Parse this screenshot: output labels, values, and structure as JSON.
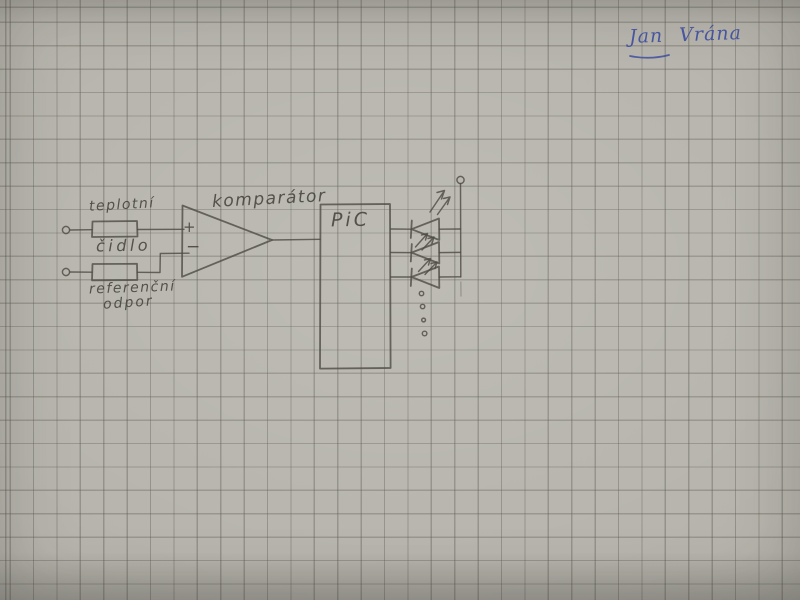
{
  "photo": {
    "type": "hand-drawn circuit sketch on squared graph paper",
    "colors": {
      "paper": "#b6b4ac",
      "grid_line": "#94928a",
      "pencil": "#4e4c45",
      "ink_blue": "#3d4d9f"
    },
    "signature": "Jan Vrána"
  },
  "diagram": {
    "labels": {
      "sensor_line1": "teplotní",
      "sensor_line2": "čidlo",
      "reference_line1": "referenční",
      "reference_line2": "odpor",
      "comparator": "komparátor",
      "plus": "+",
      "minus": "−",
      "mcu": "PiC"
    },
    "symbols": {
      "input-terminal-icon": "small open circle",
      "resistor-icon": "rectangle box",
      "comparator-icon": "triangle pointing right with + and − inputs",
      "led-icon": "left-pointing triangle with cathode bar and two emission arrows",
      "supply-terminal-icon": "small open circle on vertical bus",
      "more-outputs-icon": "vertical column of four small dots"
    }
  }
}
